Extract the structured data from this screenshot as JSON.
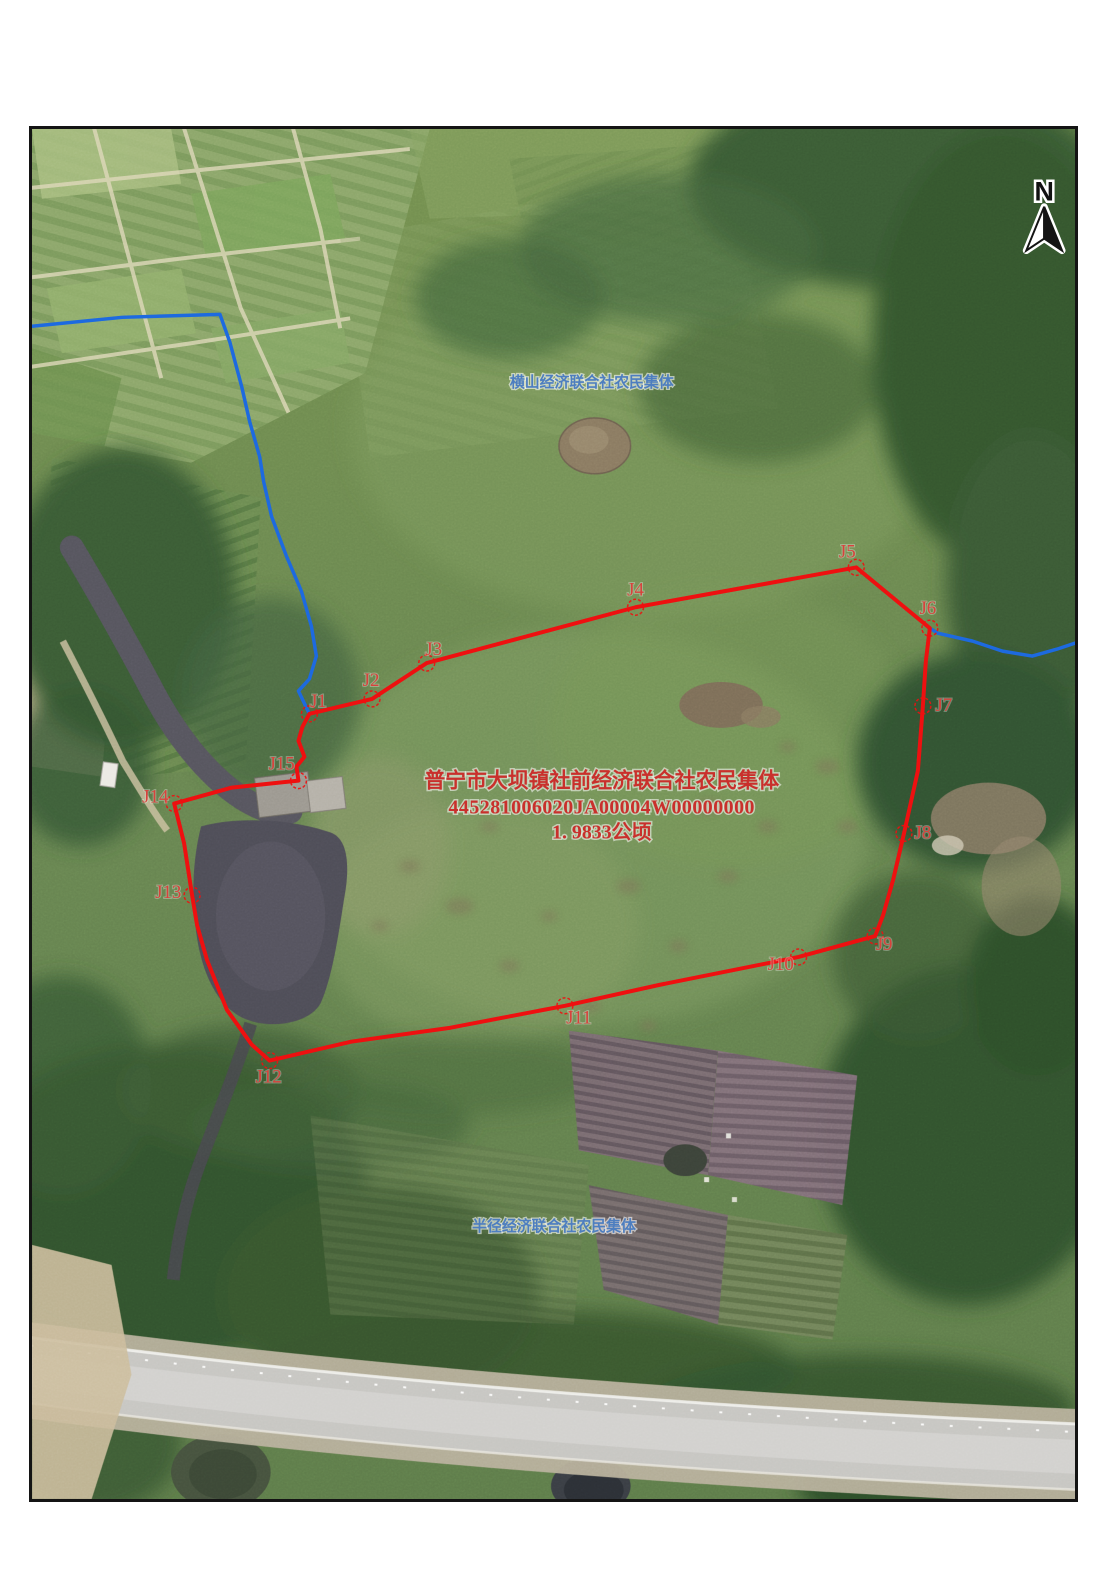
{
  "parcel": {
    "owner": "普宁市大坝镇社前经济联合社农民集体",
    "code": "445281006020JA00004W00000000",
    "area": "1. 9833公顷"
  },
  "neighbors": {
    "top": "横山经济联合社农民集体",
    "bottom": "半径经济联合社农民集体"
  },
  "north_arrow": {
    "label": "N"
  },
  "vertices": [
    {
      "label": "J1",
      "lx": 288,
      "ly": 580,
      "px": 279,
      "py": 587
    },
    {
      "label": "J2",
      "lx": 341,
      "ly": 559,
      "px": 342,
      "py": 572
    },
    {
      "label": "J3",
      "lx": 404,
      "ly": 528,
      "px": 397,
      "py": 536
    },
    {
      "label": "J4",
      "lx": 607,
      "ly": 468,
      "px": 607,
      "py": 480
    },
    {
      "label": "J5",
      "lx": 820,
      "ly": 430,
      "px": 829,
      "py": 440
    },
    {
      "label": "J6",
      "lx": 901,
      "ly": 487,
      "px": 903,
      "py": 501
    },
    {
      "label": "J7",
      "lx": 917,
      "ly": 584,
      "px": 896,
      "py": 579
    },
    {
      "label": "J8",
      "lx": 896,
      "ly": 712,
      "px": 877,
      "py": 707
    },
    {
      "label": "J9",
      "lx": 857,
      "ly": 824,
      "px": 848,
      "py": 810
    },
    {
      "label": "J10",
      "lx": 753,
      "ly": 844,
      "px": 771,
      "py": 831
    },
    {
      "label": "J11",
      "lx": 550,
      "ly": 898,
      "px": 536,
      "py": 880
    },
    {
      "label": "J12",
      "lx": 238,
      "ly": 957,
      "px": 239,
      "py": 935
    },
    {
      "label": "J13",
      "lx": 137,
      "ly": 772,
      "px": 161,
      "py": 769
    },
    {
      "label": "J14",
      "lx": 124,
      "ly": 676,
      "px": 143,
      "py": 677
    },
    {
      "label": "J15",
      "lx": 251,
      "ly": 643,
      "px": 268,
      "py": 654
    }
  ],
  "colors": {
    "parcel_boundary": "#ee1010",
    "neighbor_boundary": "#1d6ae0",
    "parcel_text": "#c9302c",
    "vertex_text": "#d8423c",
    "neighbor_text": "#4d7ec0",
    "frame": "#141414"
  }
}
